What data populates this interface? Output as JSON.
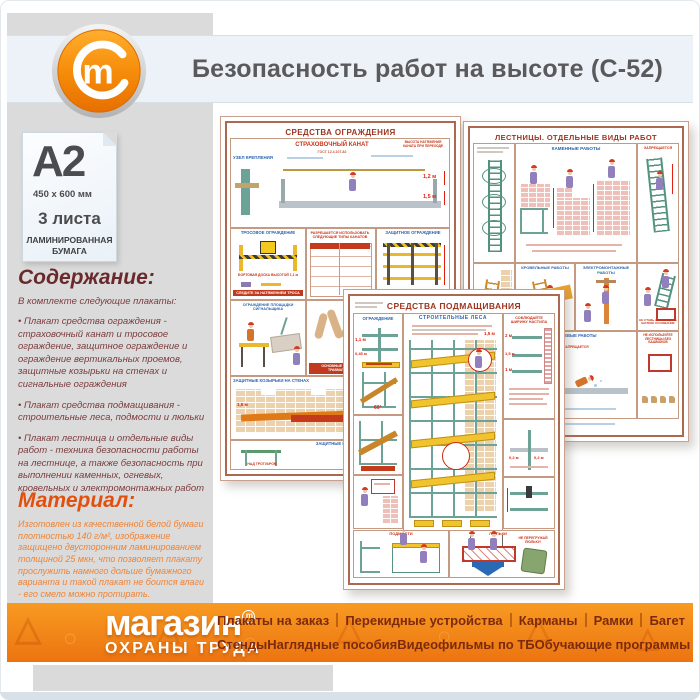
{
  "header": {
    "title": "Безопасность работ на высоте (С-52)",
    "logo_mark": "m"
  },
  "spec_card": {
    "format": "A2",
    "dimensions": "450 x 600 мм",
    "sheets": "3 листа",
    "paper_line1": "ЛАМИНИРОВАННАЯ",
    "paper_line2": "БУМАГА"
  },
  "contents": {
    "heading": "Содержание:",
    "intro": "В комплекте следующие плакаты:",
    "items": [
      "• Плакат средства ограждения - страховочный канат и тросовое ограждение, защитное ограждение и ограждение вертикальных проемов, защитные козырьки на стенах и сигнальные ограждения",
      "• Плакат средства подмащивания - строительные леса, подмости и люльки",
      "• Плакат лестница и отдельные виды работ - техника безопасности работы на лестнице, а также безопасность при выполнении каменных, огневых, кровельных и электромонтажных работ"
    ]
  },
  "material": {
    "heading": "Материал:",
    "body": "Изготовлен из качественной белой бумаги плотностью 140 г/м², изображение защищено двусторонним ламинированием толщиной 25 мкн, что позволяет плакату прослужить намного дольше бумажного варианта и такой плакат не боится влаги - его смело можно протирать."
  },
  "posters": {
    "p1": {
      "title": "СРЕДСТВА ОГРАЖДЕНИЯ",
      "labels": {
        "uzel": "УЗЕЛ КРЕПЛЕНИЯ",
        "kanat": "СТРАХОВОЧНЫЙ КАНАТ",
        "gost": "ГОСТ 12.4.107-82",
        "vysota": "ВЫСОТА НАТЯЖЕНИЯ КАНАТА ПРИ ПЕРЕХОДЕ",
        "dim12": "1,2 м",
        "dim15": "1,5 м",
        "tros": "ТРОСОВОЕ ОГРАЖДЕНИЕ",
        "bort": "БОРТОВАЯ ДОСКА ВЫСОТОЙ 1,1 м",
        "sledite": "СЛЕДИТЕ ЗА НАТЯЖЕНИЕМ ТРОСА",
        "table": "РАЗРЕШАЕТСЯ ИСПОЛЬЗОВАТЬ СЛЕДУЮЩИЕ ТИПЫ КАНАТОВ",
        "zashita": "ЗАЩИТНОЕ ОГРАЖДЕНИЕ",
        "ploshadka": "ОГРАЖДЕНИЕ ПЛОЩАДКИ СИГНАЛЬЩИКА",
        "travma": "ОСНОВНЫЕ ПРИЧИНЫ ТРАВМАТИЗМА",
        "proemy": "ОГРАЖДЕНИЕ ВЕРТИКАЛЬНЫХ ПРОЕМОВ",
        "kozyrki_steny": "ЗАЩИТНЫЕ КОЗЫРЬКИ НА СТЕНАХ",
        "kozyrki": "ЗАЩИТНЫЕ КОЗЫРЬКИ",
        "nad_trotuarom": "НАД ТРОТУАРОМ",
        "nad_prohodom": "НАД ПРОХОДОМ"
      }
    },
    "p2": {
      "title": "ЛЕСТНИЦЫ. ОТДЕЛЬНЫЕ ВИДЫ РАБОТ",
      "labels": {
        "kamennye": "КАМЕННЫЕ РАБОТЫ",
        "krovelnye": "КРОВЕЛЬНЫЕ РАБОТЫ",
        "elektro": "ЭЛЕКТРОМОНТАЖНЫЕ РАБОТЫ",
        "ognevye": "ОГНЕВЫЕ РАБОТЫ",
        "zapreshaetsya": "ЗАПРЕЩАЕТСЯ",
        "shatkoe": "НЕ СТАВЬ ЛЕСТНИЦУ НА ШАТКОЕ ОСНОВАНИЕ",
        "bashmaki": "НЕ ИСПОЛЬЗУЙТЕ ЛЕСТНИЦЫ БЕЗ БАШМАКОВ"
      }
    },
    "p3": {
      "title": "СРЕДСТВА ПОДМАЩИВАНИЯ",
      "labels": {
        "ograzhdenie": "ОГРАЖДЕНИЕ",
        "lesa": "СТРОИТЕЛЬНЫЕ ЛЕСА",
        "nastil": "СОБЛЮДАЙТЕ ШИРИНУ НАСТИЛА",
        "dim11": "1,1 м",
        "dim045": "0,45 м",
        "dim2": "2 м",
        "dim15": "1,5 м",
        "dim1": "1 м",
        "dim02": "0,2 м",
        "deg60": "60°",
        "podmosti": "ПОДМОСТИ",
        "lyulki": "ЛЮЛЬКИ",
        "ne_peregruzhay": "НЕ ПЕРЕГРУЖАЙ ЛЮЛЬКУ!"
      }
    }
  },
  "footer": {
    "logo_line1": "магазин",
    "logo_line2": "ОХРАНЫ ТРУДА",
    "logo_mark": "m",
    "menu_row1": [
      "Плакаты на заказ",
      "Перекидные устройства",
      "Карманы",
      "Рамки",
      "Багет"
    ],
    "menu_row2": [
      "Стенды",
      "Наглядные пособия",
      "Видеофильмы по ТБ",
      "Обучающие программы"
    ]
  },
  "colors": {
    "accent_orange": "#ef7d10",
    "band_blue": "#ecf2f7",
    "maroon_text": "#7d3b3d",
    "orange_text": "#f08335",
    "menu_text": "#7c2a0e",
    "poster_title_red": "#9e3520"
  }
}
